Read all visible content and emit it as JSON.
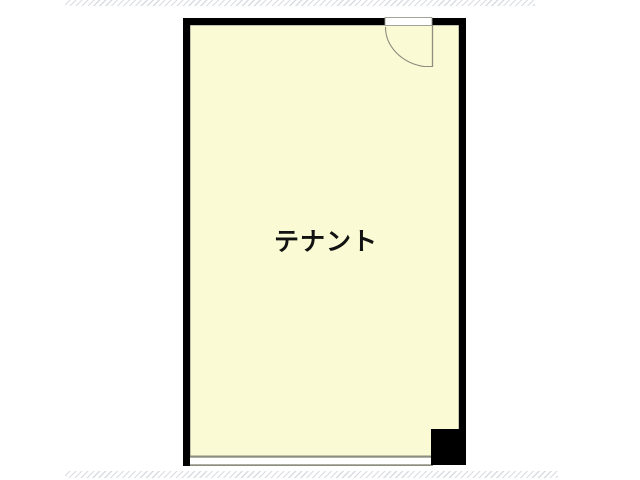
{
  "floor_plan": {
    "room_label": "テナント",
    "features": {
      "door": "swing-door-top-right",
      "pillar": "corner-pillar-bottom-right",
      "storefront": "window-line-bottom"
    }
  },
  "colors": {
    "background": "#ffffff",
    "wall": "#000000",
    "room_fill": "#fafad4",
    "thin_line": "#8d8d80",
    "hatch": "#d9dde2",
    "door_opening_fill": "#ffffff",
    "window_band_fill": "#ffffff",
    "label": "#121212"
  }
}
